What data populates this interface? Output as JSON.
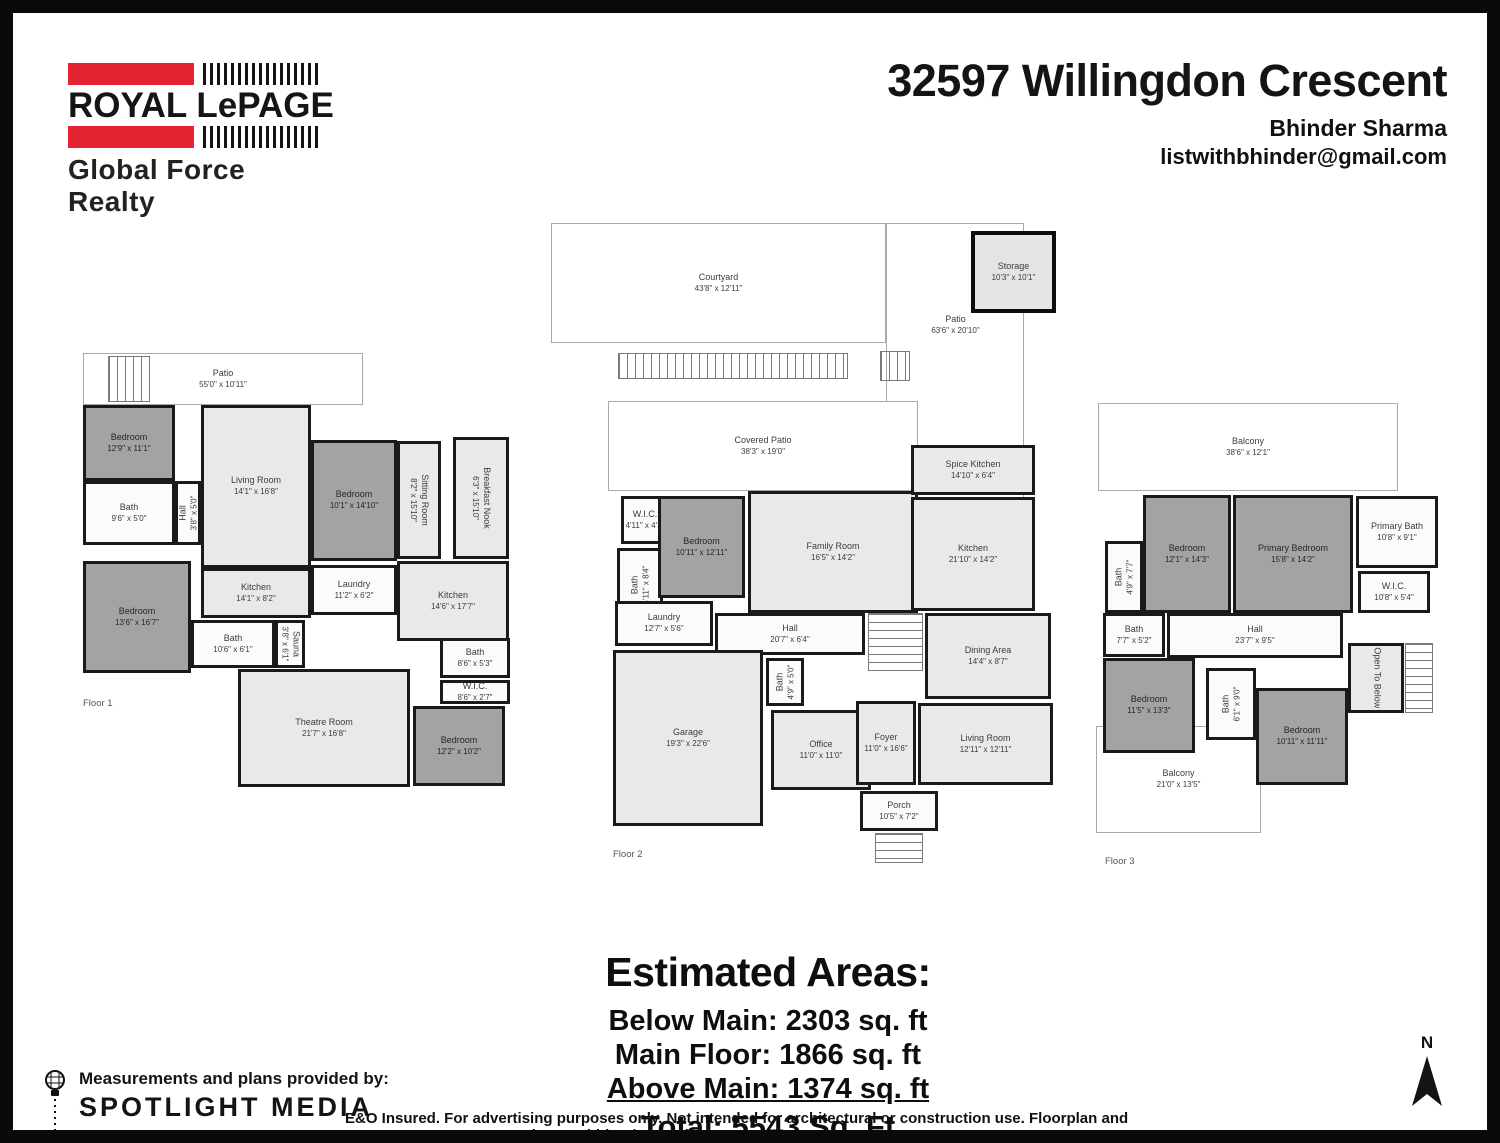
{
  "header": {
    "logo": {
      "brand": "ROYAL LePAGE",
      "tagline": "Global Force Realty",
      "red": "#e32232"
    },
    "title": "32597 Willingdon Crescent",
    "agent": "Bhinder Sharma",
    "email": "listwithbhinder@gmail.com"
  },
  "areas": {
    "heading": "Estimated Areas:",
    "below_main": "Below Main: 2303 sq. ft",
    "main_floor": "Main Floor: 1866 sq. ft",
    "above_main": "Above Main: 1374 sq. ft",
    "total": "Total: 5543 Sq. Ft"
  },
  "footer": {
    "provided_by": "Measurements and plans provided by:",
    "provider": "SPOTLIGHT MEDIA",
    "disclaimer": "E&O Insured. For advertising purposes only. Not intended for architectural or construction use. Floorplan and measurements are approximate within +/- 2% tolerance.",
    "north_label": "N"
  },
  "floors": [
    {
      "label": "Floor 1",
      "label_pos": [
        8,
        352
      ],
      "rect": [
        62,
        333,
        445,
        545
      ],
      "rooms": [
        {
          "n": "Patio",
          "d": "55'0\" x 10'11\"",
          "t": "outline",
          "r": [
            8,
            7,
            280,
            52
          ]
        },
        {
          "t": "sth",
          "r": [
            33,
            10,
            42,
            46
          ]
        },
        {
          "n": "Bedroom",
          "d": "12'9\" x 11'1\"",
          "t": "dark",
          "r": [
            8,
            59,
            92,
            76
          ]
        },
        {
          "n": "Living Room",
          "d": "14'1\" x 16'8\"",
          "t": "light",
          "r": [
            126,
            59,
            110,
            163
          ]
        },
        {
          "n": "Bedroom",
          "d": "10'1\" x 14'10\"",
          "t": "dark",
          "r": [
            236,
            94,
            86,
            121
          ]
        },
        {
          "n": "Sitting Room",
          "d": "8'2\" x 15'10\"",
          "t": "light",
          "rot": 1,
          "r": [
            322,
            95,
            44,
            118
          ]
        },
        {
          "n": "Breakfast Nook",
          "d": "6'3\" x 15'10\"",
          "t": "light",
          "rot": 1,
          "r": [
            378,
            91,
            56,
            122
          ]
        },
        {
          "n": "Bath",
          "d": "9'6\" x 5'0\"",
          "t": "svc",
          "r": [
            8,
            135,
            92,
            64
          ]
        },
        {
          "n": "Hall",
          "d": "3'8\" x 5'0\"",
          "t": "svc",
          "rot": -1,
          "r": [
            100,
            135,
            26,
            64
          ]
        },
        {
          "n": "Bedroom",
          "d": "13'6\" x 16'7\"",
          "t": "dark",
          "r": [
            8,
            215,
            108,
            112
          ]
        },
        {
          "n": "Kitchen",
          "d": "14'1\" x 8'2\"",
          "t": "light",
          "r": [
            126,
            222,
            110,
            50
          ]
        },
        {
          "n": "Laundry",
          "d": "11'2\" x 6'2\"",
          "t": "svc",
          "r": [
            236,
            219,
            86,
            50
          ]
        },
        {
          "n": "Kitchen",
          "d": "14'6\" x 17'7\"",
          "t": "light",
          "r": [
            322,
            215,
            112,
            80
          ]
        },
        {
          "n": "Bath",
          "d": "10'6\" x 6'1\"",
          "t": "svc",
          "r": [
            116,
            274,
            84,
            48
          ]
        },
        {
          "n": "Sauna",
          "d": "3'8\" x 6'1\"",
          "t": "svc",
          "rot": 1,
          "r": [
            200,
            274,
            30,
            48
          ]
        },
        {
          "n": "Theatre Room",
          "d": "21'7\" x 16'8\"",
          "t": "light",
          "r": [
            163,
            323,
            172,
            118
          ]
        },
        {
          "n": "Bath",
          "d": "8'6\" x 5'3\"",
          "t": "svc",
          "r": [
            365,
            292,
            70,
            40
          ]
        },
        {
          "n": "W.I.C.",
          "d": "8'6\" x 2'7\"",
          "t": "svc",
          "r": [
            365,
            334,
            70,
            24
          ]
        },
        {
          "n": "Bedroom",
          "d": "12'2\" x 10'2\"",
          "t": "dark",
          "r": [
            338,
            360,
            92,
            80
          ]
        }
      ]
    },
    {
      "label": "Floor 2",
      "label_pos": [
        65,
        636
      ],
      "rect": [
        535,
        200,
        510,
        660
      ],
      "rooms": [
        {
          "n": "Courtyard",
          "d": "43'8\" x 12'11\"",
          "t": "outline",
          "r": [
            3,
            10,
            335,
            120
          ]
        },
        {
          "t": "outline",
          "r": [
            338,
            10,
            138,
            300
          ]
        },
        {
          "n": "Patio",
          "d": "63'6\" x 20'10\"",
          "t": "plain",
          "r": [
            345,
            92,
            125,
            40
          ]
        },
        {
          "n": "Storage",
          "d": "10'3\" x 10'1\"",
          "t": "storage",
          "r": [
            423,
            18,
            85,
            82
          ]
        },
        {
          "t": "sth",
          "r": [
            70,
            140,
            230,
            26
          ]
        },
        {
          "t": "sth",
          "r": [
            332,
            138,
            30,
            30
          ]
        },
        {
          "n": "Covered Patio",
          "d": "38'3\" x 19'0\"",
          "t": "outline",
          "r": [
            60,
            188,
            310,
            90
          ]
        },
        {
          "n": "W.I.C.",
          "d": "4'11\" x 4'1\"",
          "t": "svc",
          "r": [
            73,
            283,
            48,
            48
          ]
        },
        {
          "n": "Bath",
          "d": "4'11\" x 8'4\"",
          "t": "svc",
          "rot": -1,
          "r": [
            69,
            335,
            46,
            75
          ]
        },
        {
          "n": "Bedroom",
          "d": "10'11\" x 12'11\"",
          "t": "dark",
          "r": [
            110,
            283,
            87,
            102
          ]
        },
        {
          "n": "Family Room",
          "d": "16'5\" x 14'2\"",
          "t": "light",
          "r": [
            200,
            278,
            170,
            122
          ]
        },
        {
          "n": "Spice Kitchen",
          "d": "14'10\" x 6'4\"",
          "t": "light",
          "r": [
            363,
            232,
            124,
            50
          ]
        },
        {
          "n": "Kitchen",
          "d": "21'10\" x 14'2\"",
          "t": "light",
          "r": [
            363,
            284,
            124,
            114
          ]
        },
        {
          "n": "Laundry",
          "d": "12'7\" x 5'6\"",
          "t": "svc",
          "r": [
            67,
            388,
            98,
            45
          ]
        },
        {
          "n": "Hall",
          "d": "20'7\" x 6'4\"",
          "t": "svc",
          "r": [
            167,
            400,
            150,
            42
          ]
        },
        {
          "t": "stv",
          "r": [
            320,
            400,
            55,
            58
          ]
        },
        {
          "n": "Garage",
          "d": "19'3\" x 22'6\"",
          "t": "light",
          "r": [
            65,
            437,
            150,
            176
          ]
        },
        {
          "n": "Bath",
          "d": "4'9\" x 5'0\"",
          "t": "svc",
          "rot": -1,
          "r": [
            218,
            445,
            38,
            48
          ]
        },
        {
          "n": "Office",
          "d": "11'0\" x 11'0\"",
          "t": "light",
          "r": [
            223,
            497,
            100,
            80
          ]
        },
        {
          "n": "Dining Area",
          "d": "14'4\" x 8'7\"",
          "t": "light",
          "r": [
            377,
            400,
            126,
            86
          ]
        },
        {
          "n": "Living Room",
          "d": "12'11\" x 12'11\"",
          "t": "light",
          "r": [
            370,
            490,
            135,
            82
          ]
        },
        {
          "n": "Foyer",
          "d": "11'0\" x 16'6\"",
          "t": "light",
          "r": [
            308,
            488,
            60,
            84
          ]
        },
        {
          "n": "Porch",
          "d": "10'5\" x 7'2\"",
          "t": "svc",
          "r": [
            312,
            578,
            78,
            40
          ]
        },
        {
          "t": "stv",
          "r": [
            327,
            620,
            48,
            30
          ]
        }
      ]
    },
    {
      "label": "Floor 3",
      "label_pos": [
        14,
        458
      ],
      "rect": [
        1078,
        385,
        365,
        475
      ],
      "rooms": [
        {
          "n": "Balcony",
          "d": "38'6\" x 12'1\"",
          "t": "outline",
          "r": [
            7,
            5,
            300,
            88
          ]
        },
        {
          "n": "Bedroom",
          "d": "12'1\" x 14'3\"",
          "t": "dark",
          "r": [
            52,
            97,
            88,
            118
          ]
        },
        {
          "n": "Primary Bedroom",
          "d": "15'8\" x 14'2\"",
          "t": "dark",
          "r": [
            142,
            97,
            120,
            118
          ]
        },
        {
          "n": "Primary Bath",
          "d": "10'8\" x 9'1\"",
          "t": "svc",
          "r": [
            265,
            98,
            82,
            72
          ]
        },
        {
          "n": "W.I.C.",
          "d": "10'8\" x 5'4\"",
          "t": "svc",
          "r": [
            267,
            173,
            72,
            42
          ]
        },
        {
          "n": "Bath",
          "d": "4'9\" x 7'7\"",
          "t": "svc",
          "rot": -1,
          "r": [
            14,
            143,
            38,
            72
          ]
        },
        {
          "n": "Bath",
          "d": "7'7\" x 5'2\"",
          "t": "svc",
          "r": [
            12,
            215,
            62,
            44
          ]
        },
        {
          "n": "Hall",
          "d": "23'7\" x 9'5\"",
          "t": "svc",
          "r": [
            76,
            215,
            176,
            45
          ]
        },
        {
          "n": "Bedroom",
          "d": "11'5\" x 13'3\"",
          "t": "dark",
          "r": [
            12,
            260,
            92,
            95
          ]
        },
        {
          "n": "Bath",
          "d": "6'1\" x 9'0\"",
          "t": "svc",
          "rot": -1,
          "r": [
            115,
            270,
            50,
            72
          ]
        },
        {
          "n": "Bedroom",
          "d": "10'11\" x 11'11\"",
          "t": "dark",
          "r": [
            165,
            290,
            92,
            97
          ]
        },
        {
          "n": "Open To Below",
          "d": "",
          "t": "light",
          "rot": 1,
          "r": [
            257,
            245,
            56,
            70
          ]
        },
        {
          "t": "stv",
          "r": [
            314,
            245,
            28,
            70
          ]
        },
        {
          "n": "Balcony",
          "d": "21'0\" x 13'5\"",
          "t": "outline",
          "r": [
            5,
            328,
            165,
            107
          ]
        }
      ]
    }
  ]
}
